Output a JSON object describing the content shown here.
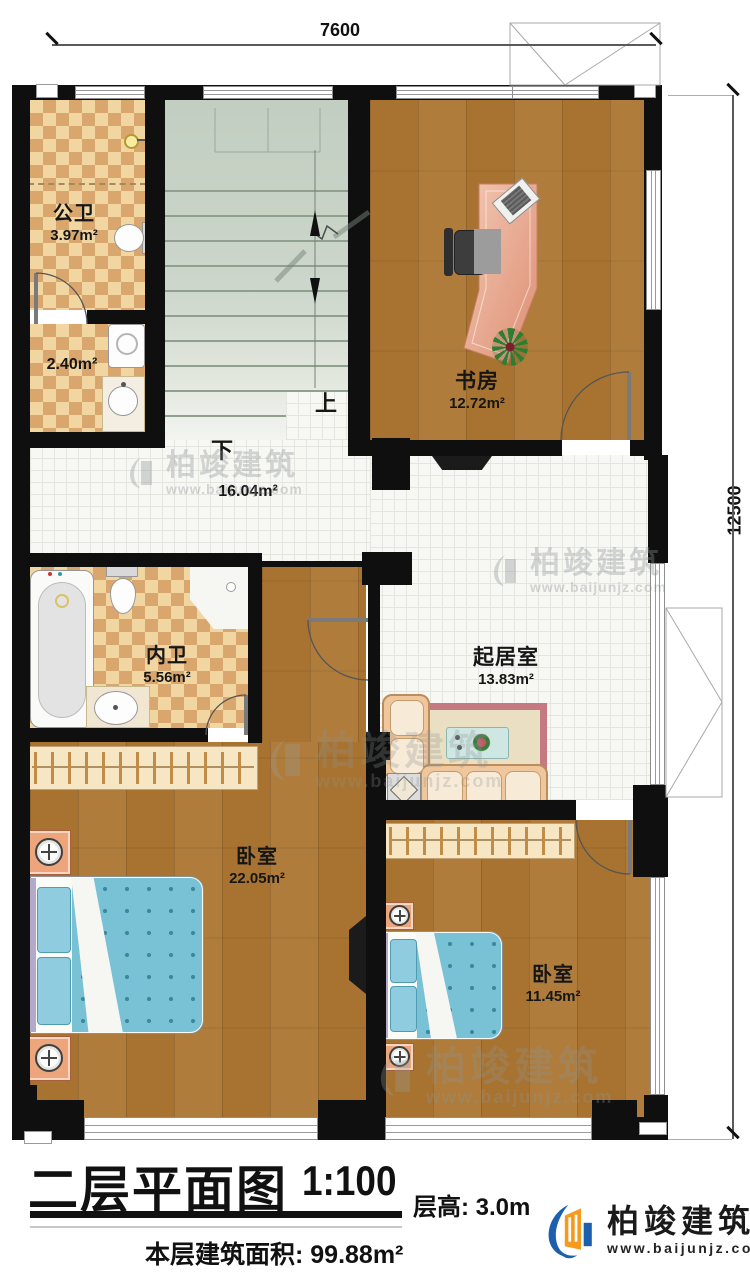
{
  "dimensions": {
    "top": "7600",
    "right": "12500"
  },
  "rooms": {
    "public_bath": {
      "name": "公卫",
      "area": "3.97m²"
    },
    "laundry": {
      "area": "2.40m²"
    },
    "hall": {
      "area": "16.04m²"
    },
    "study": {
      "name": "书房",
      "area": "12.72m²"
    },
    "master_bath": {
      "name": "内卫",
      "area": "5.56m²"
    },
    "living": {
      "name": "起居室",
      "area": "13.83m²"
    },
    "bedroom_big": {
      "name": "卧室",
      "area": "22.05m²"
    },
    "bedroom_small": {
      "name": "卧室",
      "area": "11.45m²"
    }
  },
  "stairs": {
    "up": "上",
    "down": "下"
  },
  "titleblock": {
    "title": "二层平面图",
    "scale": "1:100",
    "floor_height": "层高: 3.0m",
    "floor_area": "本层建筑面积: 99.88m²"
  },
  "logo": {
    "name": "柏竣建筑",
    "url": "www.baijunjz.com"
  },
  "watermark": {
    "name": "柏竣建筑",
    "url": "www.baijunjz.com"
  },
  "colors": {
    "logo_blue": "#1c5faf",
    "logo_orange": "#f59a1c",
    "wood": "#a87330",
    "tile_tan": "#d9a76e"
  }
}
